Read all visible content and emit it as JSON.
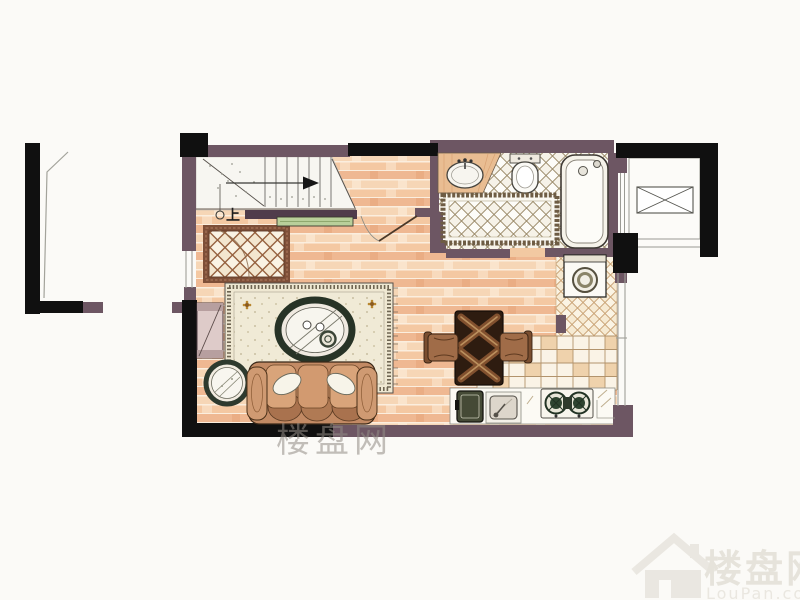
{
  "plan": {
    "type": "studio apartment floor plan (hand-rendered)",
    "stairs": {
      "up_label": "上",
      "arrow_icon": "right-arrow-icon"
    },
    "watermark_center": {
      "text": "楼盘网"
    },
    "watermark_bottom_right": {
      "brand": "楼盘网",
      "domain": "LouPan.com",
      "icon": "house-icon"
    },
    "colors": {
      "background": "#fbfaf7",
      "wall_black": "#101010",
      "wall_purple": "#6d5663",
      "stair_wall": "#503c4b",
      "wood_floor_mid": "#efb892",
      "entry_tile_border": "#7e4f38",
      "shoe_cabinet_green": "#b9cf9a",
      "rug_cream": "#efe8d2",
      "sofa_brown": "#c28a64",
      "dining_table_dark": "#2e1c10",
      "burner_green": "#2e4430"
    },
    "fixtures": [
      "staircase",
      "entry-tile-area",
      "shoe-cabinet",
      "entry-door",
      "living-rug",
      "coffee-table",
      "side-table",
      "sofa",
      "armchair",
      "dining-table",
      "dining-chairs",
      "kitchen-floor",
      "kitchen-counter",
      "oven",
      "kitchen-sink",
      "gas-stove",
      "utility-floor",
      "washing-machine",
      "bathroom-sink",
      "toilet",
      "bathtub",
      "bath-mat",
      "elevator-shaft",
      "windows"
    ]
  }
}
